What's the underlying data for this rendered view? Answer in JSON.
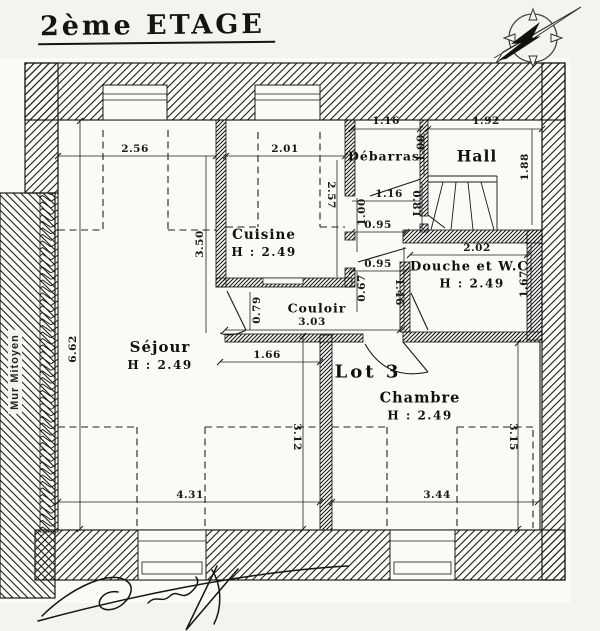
{
  "title": "2ème ETAGE",
  "party_wall_label": "Mur Mitoyen",
  "lot": {
    "label": "Lot 3"
  },
  "compass": {
    "icon": "north-arrow-icon"
  },
  "colors": {
    "ink": "#1a1a1a",
    "paper": "#f4f3ee"
  },
  "rooms": [
    {
      "id": "sejour",
      "name": "Séjour",
      "height_label": "H : 2.49",
      "x": 160,
      "y": 355,
      "fs": 15
    },
    {
      "id": "cuisine",
      "name": "Cuisine",
      "height_label": "H : 2.49",
      "x": 264,
      "y": 243,
      "fs": 13.5
    },
    {
      "id": "debarras",
      "name": "Débarras",
      "height_label": "",
      "x": 384,
      "y": 156,
      "fs": 12.5
    },
    {
      "id": "hall",
      "name": "Hall",
      "height_label": "",
      "x": 477,
      "y": 156,
      "fs": 15.5
    },
    {
      "id": "douche",
      "name": "Douche et W.C.",
      "height_label": "H : 2.49",
      "x": 472,
      "y": 275,
      "fs": 13
    },
    {
      "id": "couloir",
      "name": "Couloir",
      "height_label": "",
      "x": 317,
      "y": 308,
      "fs": 12.5
    },
    {
      "id": "chambre",
      "name": "Chambre",
      "height_label": "H : 2.49",
      "x": 420,
      "y": 406,
      "fs": 14.5
    }
  ],
  "dimensions": [
    {
      "t": "2.56",
      "x": 135,
      "y": 149,
      "r": 0
    },
    {
      "t": "2.01",
      "x": 285,
      "y": 149,
      "r": 0
    },
    {
      "t": "1.16",
      "x": 386,
      "y": 121,
      "r": 0
    },
    {
      "t": "1.92",
      "x": 486,
      "y": 121,
      "r": 0
    },
    {
      "t": "1.00",
      "x": 421,
      "y": 148,
      "r": -90
    },
    {
      "t": "1.88",
      "x": 525,
      "y": 167,
      "r": -90
    },
    {
      "t": "2.57",
      "x": 331,
      "y": 195,
      "r": 90
    },
    {
      "t": "3.50",
      "x": 200,
      "y": 244,
      "r": -90
    },
    {
      "t": "1.16",
      "x": 389,
      "y": 194,
      "r": 0
    },
    {
      "t": "0.81",
      "x": 416,
      "y": 204,
      "r": 90
    },
    {
      "t": "1.00",
      "x": 362,
      "y": 212,
      "r": -90
    },
    {
      "t": "0.95",
      "x": 378,
      "y": 225,
      "r": 0
    },
    {
      "t": "0.95",
      "x": 378,
      "y": 264,
      "r": 0
    },
    {
      "t": "0.67",
      "x": 362,
      "y": 288,
      "r": -90
    },
    {
      "t": "1.46",
      "x": 399,
      "y": 292,
      "r": 90
    },
    {
      "t": "2.02",
      "x": 477,
      "y": 248,
      "r": 0
    },
    {
      "t": "1.67",
      "x": 524,
      "y": 284,
      "r": -90
    },
    {
      "t": "0.79",
      "x": 257,
      "y": 310,
      "r": -90
    },
    {
      "t": "3.03",
      "x": 312,
      "y": 322,
      "r": 0
    },
    {
      "t": "1.66",
      "x": 267,
      "y": 355,
      "r": 0
    },
    {
      "t": "6.62",
      "x": 73,
      "y": 349,
      "r": -90
    },
    {
      "t": "3.12",
      "x": 297,
      "y": 437,
      "r": 90
    },
    {
      "t": "3.15",
      "x": 513,
      "y": 437,
      "r": 90
    },
    {
      "t": "4.31",
      "x": 190,
      "y": 495,
      "r": 0
    },
    {
      "t": "3.44",
      "x": 437,
      "y": 495,
      "r": 0
    }
  ]
}
